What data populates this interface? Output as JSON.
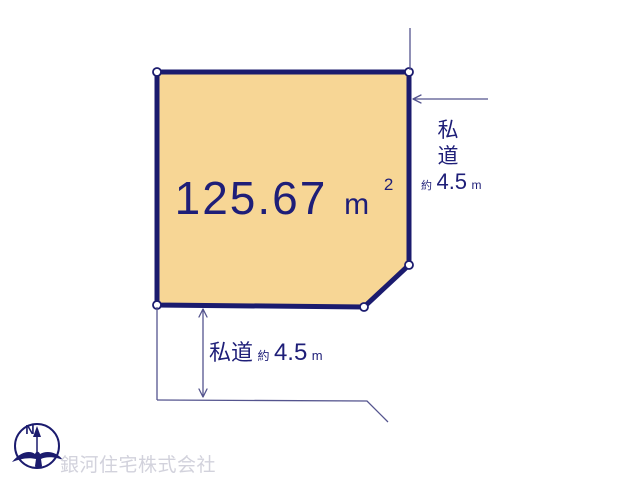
{
  "plot": {
    "area_value": "125.67",
    "area_unit": "m",
    "area_superscript": "2",
    "fill_color": "#F7D695",
    "border_color": "#1B1B6E"
  },
  "right_road": {
    "label_char1": "私",
    "label_char2": "道",
    "approx_prefix": "約",
    "width_value": "4.5",
    "width_unit": "m"
  },
  "bottom_road": {
    "label": "私道",
    "approx_prefix": "約",
    "width_value": "4.5",
    "width_unit": "m"
  },
  "compass": {
    "north_label": "N"
  },
  "watermark": {
    "company_name": "銀河住宅株式会社",
    "color": "#D2D2DC"
  },
  "colors": {
    "line": "#54548E",
    "text": "#1E1E78"
  }
}
